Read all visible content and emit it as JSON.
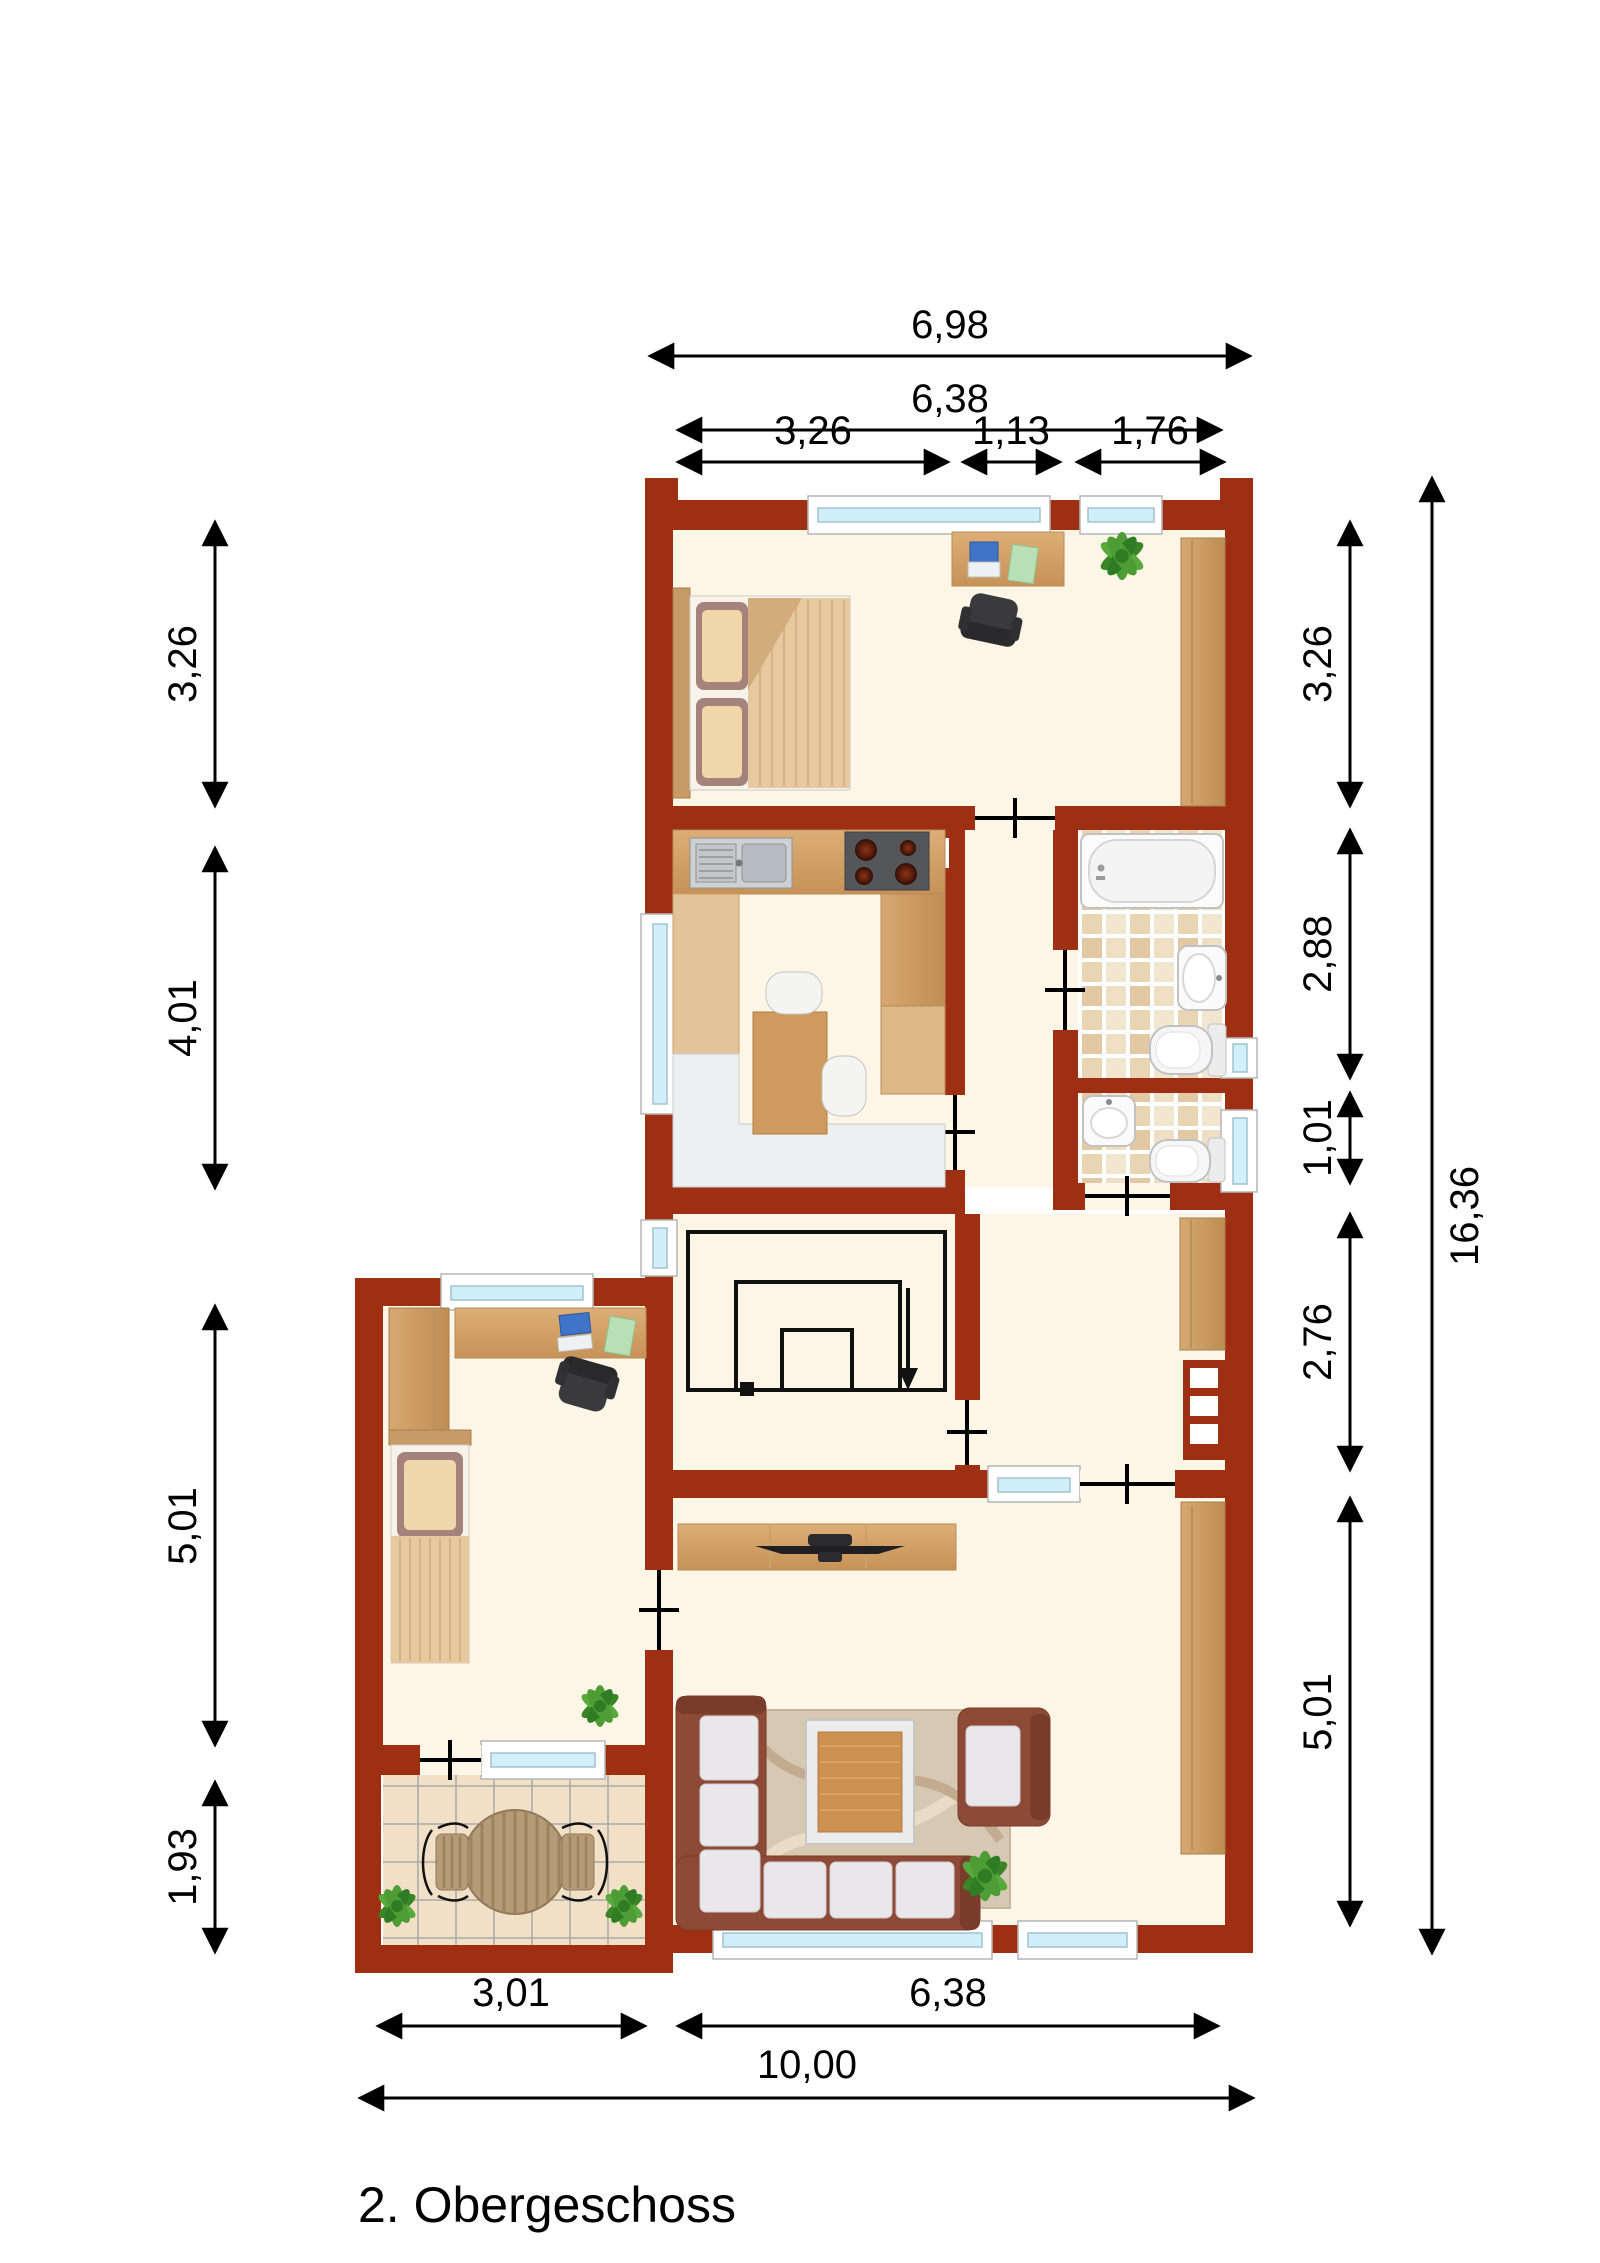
{
  "title": "2. Obergeschoss",
  "dimensions": {
    "top_total": "6,98",
    "top_inner": "6,38",
    "top_segments": [
      "3,26",
      "1,13",
      "1,76"
    ],
    "left": [
      "3,26",
      "4,01",
      "5,01",
      "1,93"
    ],
    "right": [
      "3,26",
      "2,88",
      "1,01",
      "2,76",
      "5,01"
    ],
    "right_total": "16,36",
    "bottom": [
      "3,01",
      "6,38"
    ],
    "bottom_total": "10,00"
  },
  "colors": {
    "wall": "#9e2f13",
    "floor": "#fdf5e6",
    "window_glass": "#d2eef8",
    "wood": "#cf9a5d",
    "sofa": "#8d4a36",
    "cushion": "#e9e7ea",
    "plant": "#4d9c34",
    "bath_tile": "#e9d4b4",
    "balcony_tile": "#f2e0c6"
  }
}
